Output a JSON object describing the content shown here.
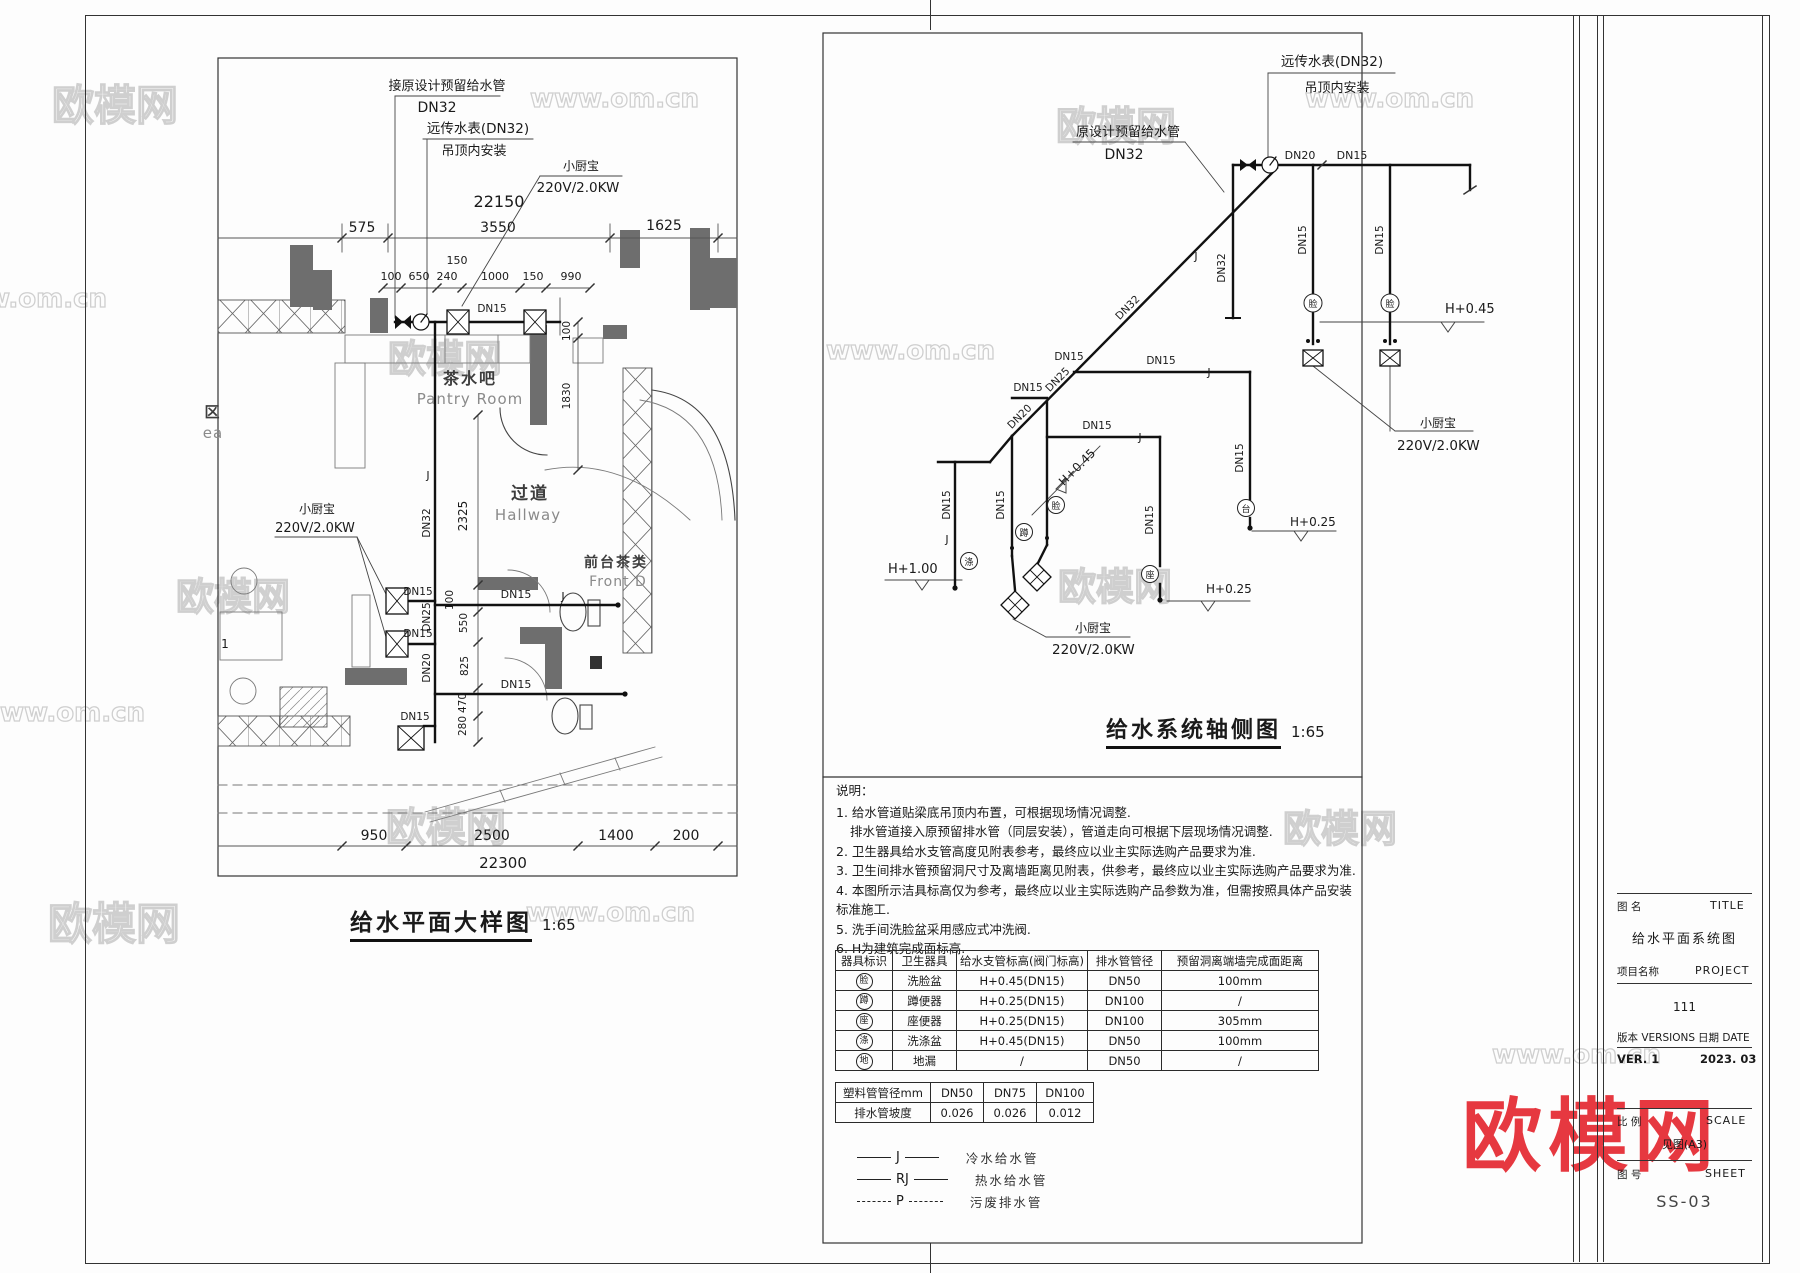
{
  "plan": {
    "title": "给水平面大样图",
    "scale": "1:65",
    "labels": [
      {
        "t": "接原设计预留给水管",
        "x": 447,
        "y": 90,
        "s": 13
      },
      {
        "t": "DN32",
        "x": 437,
        "y": 112,
        "s": 14
      },
      {
        "t": "远传水表(DN32)",
        "x": 478,
        "y": 133,
        "s": 13.5
      },
      {
        "t": "吊顶内安装",
        "x": 474,
        "y": 155,
        "s": 13
      },
      {
        "t": "小厨宝",
        "x": 581,
        "y": 170,
        "s": 12
      },
      {
        "t": "220V/2.0KW",
        "x": 578,
        "y": 192,
        "s": 13.5
      },
      {
        "t": "22150",
        "x": 499,
        "y": 207,
        "s": 16
      },
      {
        "t": "575",
        "x": 362,
        "y": 232,
        "s": 14
      },
      {
        "t": "3550",
        "x": 498,
        "y": 232,
        "s": 14
      },
      {
        "t": "1625",
        "x": 664,
        "y": 230,
        "s": 14
      },
      {
        "t": "150",
        "x": 457,
        "y": 264,
        "s": 11
      },
      {
        "t": "100",
        "x": 391,
        "y": 280,
        "s": 11
      },
      {
        "t": "650",
        "x": 419,
        "y": 280,
        "s": 11
      },
      {
        "t": "240",
        "x": 447,
        "y": 280,
        "s": 11
      },
      {
        "t": "1000",
        "x": 495,
        "y": 280,
        "s": 11
      },
      {
        "t": "150",
        "x": 533,
        "y": 280,
        "s": 11
      },
      {
        "t": "990",
        "x": 571,
        "y": 280,
        "s": 11
      },
      {
        "t": "DN15",
        "x": 492,
        "y": 312,
        "s": 10.5
      },
      {
        "t": "100",
        "x": 570,
        "y": 331,
        "s": 10.5,
        "r": -90
      },
      {
        "t": "1830",
        "x": 570,
        "y": 396,
        "s": 10.5,
        "r": -90
      },
      {
        "t": "茶水吧",
        "x": 470,
        "y": 384,
        "s": 16,
        "c": "room"
      },
      {
        "t": "Pantry Room",
        "x": 470,
        "y": 404,
        "s": 15,
        "c": "rooml"
      },
      {
        "t": "过道",
        "x": 530,
        "y": 499,
        "s": 17,
        "c": "room"
      },
      {
        "t": "Hallway",
        "x": 528,
        "y": 520,
        "s": 15,
        "c": "rooml"
      },
      {
        "t": "2325",
        "x": 467,
        "y": 516,
        "s": 12,
        "r": -90
      },
      {
        "t": "DN32",
        "x": 430,
        "y": 523,
        "s": 10.5,
        "r": -90
      },
      {
        "t": "J",
        "x": 428,
        "y": 479,
        "s": 11
      },
      {
        "t": "小厨宝",
        "x": 317,
        "y": 513,
        "s": 12
      },
      {
        "t": "220V/2.0KW",
        "x": 315,
        "y": 532,
        "s": 13
      },
      {
        "t": "DN15",
        "x": 418,
        "y": 595,
        "s": 10.5
      },
      {
        "t": "DN25",
        "x": 430,
        "y": 617,
        "s": 10.5,
        "r": -90
      },
      {
        "t": "DN15",
        "x": 418,
        "y": 637,
        "s": 10.5
      },
      {
        "t": "DN20",
        "x": 430,
        "y": 668,
        "s": 10.5,
        "r": -90
      },
      {
        "t": "100",
        "x": 453,
        "y": 600,
        "s": 10.5,
        "r": -90
      },
      {
        "t": "550",
        "x": 467,
        "y": 623,
        "s": 10.5,
        "r": -90
      },
      {
        "t": "825",
        "x": 468,
        "y": 666,
        "s": 10.5,
        "r": -90
      },
      {
        "t": "470",
        "x": 466,
        "y": 703,
        "s": 10.5,
        "r": -90
      },
      {
        "t": "280",
        "x": 466,
        "y": 726,
        "s": 10.5,
        "r": -90
      },
      {
        "t": "DN15",
        "x": 516,
        "y": 598,
        "s": 11
      },
      {
        "t": "J",
        "x": 563,
        "y": 600,
        "s": 11
      },
      {
        "t": "DN15",
        "x": 516,
        "y": 688,
        "s": 11
      },
      {
        "t": "DN15",
        "x": 415,
        "y": 720,
        "s": 10.5
      },
      {
        "t": "区",
        "x": 213,
        "y": 417,
        "s": 15,
        "c": "room"
      },
      {
        "t": "ea",
        "x": 213,
        "y": 438,
        "s": 15,
        "c": "rooml"
      },
      {
        "t": "1",
        "x": 225,
        "y": 648,
        "s": 12
      },
      {
        "t": "前台茶类",
        "x": 616,
        "y": 567,
        "s": 14,
        "c": "room"
      },
      {
        "t": "Front D",
        "x": 618,
        "y": 586,
        "s": 14,
        "c": "rooml"
      },
      {
        "t": "950",
        "x": 374,
        "y": 840,
        "s": 14
      },
      {
        "t": "2500",
        "x": 492,
        "y": 840,
        "s": 14
      },
      {
        "t": "1400",
        "x": 616,
        "y": 840,
        "s": 14
      },
      {
        "t": "200",
        "x": 686,
        "y": 840,
        "s": 14
      },
      {
        "t": "22300",
        "x": 503,
        "y": 868,
        "s": 15
      }
    ]
  },
  "axon": {
    "title": "给水系统轴侧图",
    "scale": "1:65",
    "labels": [
      {
        "t": "远传水表(DN32)",
        "x": 1332,
        "y": 66,
        "s": 13.5
      },
      {
        "t": "吊顶内安装",
        "x": 1337,
        "y": 92,
        "s": 13
      },
      {
        "t": "原设计预留给水管",
        "x": 1128,
        "y": 136,
        "s": 13
      },
      {
        "t": "DN32",
        "x": 1124,
        "y": 159,
        "s": 14
      },
      {
        "t": "DN20",
        "x": 1300,
        "y": 159,
        "s": 11
      },
      {
        "t": "DN15",
        "x": 1352,
        "y": 159,
        "s": 11
      },
      {
        "t": "DN32",
        "x": 1225,
        "y": 268,
        "s": 10.5,
        "r": -90
      },
      {
        "t": "DN32",
        "x": 1130,
        "y": 310,
        "s": 10.5,
        "r": -45
      },
      {
        "t": "J",
        "x": 1196,
        "y": 260,
        "s": 11
      },
      {
        "t": "DN15",
        "x": 1306,
        "y": 240,
        "s": 10.5,
        "r": -90
      },
      {
        "t": "DN15",
        "x": 1383,
        "y": 240,
        "s": 10.5,
        "r": -90
      },
      {
        "t": "脸",
        "x": 1313,
        "y": 307,
        "s": 9
      },
      {
        "t": "脸",
        "x": 1390,
        "y": 307,
        "s": 9
      },
      {
        "t": "H+0.45",
        "x": 1445,
        "y": 313,
        "s": 13,
        "a": "start"
      },
      {
        "t": "小厨宝",
        "x": 1420,
        "y": 427,
        "s": 12,
        "a": "start"
      },
      {
        "t": "220V/2.0KW",
        "x": 1397,
        "y": 450,
        "s": 13.5,
        "a": "start"
      },
      {
        "t": "DN15",
        "x": 1069,
        "y": 360,
        "s": 10.5
      },
      {
        "t": "DN25",
        "x": 1060,
        "y": 382,
        "s": 10.5,
        "r": -45
      },
      {
        "t": "DN15",
        "x": 1161,
        "y": 364,
        "s": 10.5
      },
      {
        "t": "DN15",
        "x": 1028,
        "y": 391,
        "s": 10.5
      },
      {
        "t": "DN20",
        "x": 1022,
        "y": 419,
        "s": 10.5,
        "r": -45
      },
      {
        "t": "DN15",
        "x": 1097,
        "y": 429,
        "s": 10.5
      },
      {
        "t": "J",
        "x": 1209,
        "y": 376,
        "s": 11
      },
      {
        "t": "J",
        "x": 1140,
        "y": 441,
        "s": 11
      },
      {
        "t": "DN15",
        "x": 1243,
        "y": 458,
        "s": 10.5,
        "r": -90
      },
      {
        "t": "H+0.45",
        "x": 1080,
        "y": 470,
        "s": 12,
        "r": -45
      },
      {
        "t": "DN15",
        "x": 950,
        "y": 505,
        "s": 10.5,
        "r": -90
      },
      {
        "t": "DN15",
        "x": 1004,
        "y": 505,
        "s": 10.5,
        "r": -90
      },
      {
        "t": "DN15",
        "x": 1153,
        "y": 520,
        "s": 10.5,
        "r": -90
      },
      {
        "t": "J",
        "x": 947,
        "y": 543,
        "s": 11
      },
      {
        "t": "H+1.00",
        "x": 888,
        "y": 573,
        "s": 13,
        "a": "start"
      },
      {
        "t": "涤",
        "x": 969,
        "y": 565,
        "s": 9
      },
      {
        "t": "蹲",
        "x": 1024,
        "y": 536,
        "s": 9
      },
      {
        "t": "脸",
        "x": 1056,
        "y": 509,
        "s": 9
      },
      {
        "t": "座",
        "x": 1150,
        "y": 578,
        "s": 9
      },
      {
        "t": "台",
        "x": 1246,
        "y": 512,
        "s": 9
      },
      {
        "t": "H+0.25",
        "x": 1290,
        "y": 526,
        "s": 12,
        "a": "start"
      },
      {
        "t": "H+0.25",
        "x": 1206,
        "y": 593,
        "s": 12,
        "a": "start"
      },
      {
        "t": "小厨宝",
        "x": 1075,
        "y": 632,
        "s": 12,
        "a": "start"
      },
      {
        "t": "220V/2.0KW",
        "x": 1052,
        "y": 654,
        "s": 13.5,
        "a": "start"
      }
    ]
  },
  "notes": {
    "heading": "说明：",
    "lines": [
      {
        "n": "1.",
        "t": "给水管道贴梁底吊顶内布置，可根据现场情况调整."
      },
      {
        "n": "",
        "t": "排水管道接入原预留排水管（同层安装），管道走向可根据下层现场情况调整."
      },
      {
        "n": "2.",
        "t": "卫生器具给水支管高度见附表参考，最终应以业主实际选购产品要求为准."
      },
      {
        "n": "3.",
        "t": "卫生间排水管预留洞尺寸及离墙距离见附表，供参考，最终应以业主实际选购产品要求为准."
      },
      {
        "n": "4.",
        "t": "本图所示洁具标高仅为参考，最终应以业主实际选购产品参数为准，但需按照具体产品安装标准施工."
      },
      {
        "n": "5.",
        "t": "洗手间洗脸盆采用感应式冲洗阀."
      },
      {
        "n": "6.",
        "t": "H为建筑完成面标高."
      }
    ]
  },
  "fixture_table": {
    "headers": [
      "器具标识",
      "卫生器具",
      "给水支管标高(阀门标高)",
      "排水管管径",
      "预留洞离端墙完成面距离"
    ],
    "rows": [
      [
        "脸",
        "洗脸盆",
        "H+0.45(DN15)",
        "DN50",
        "100mm"
      ],
      [
        "蹲",
        "蹲便器",
        "H+0.25(DN15)",
        "DN100",
        "/"
      ],
      [
        "座",
        "座便器",
        "H+0.25(DN15)",
        "DN100",
        "305mm"
      ],
      [
        "涤",
        "洗涤盆",
        "H+0.45(DN15)",
        "DN50",
        "100mm"
      ],
      [
        "地",
        "地漏",
        "/",
        "DN50",
        "/"
      ]
    ]
  },
  "slope_table": {
    "rows": [
      [
        "塑料管管径mm",
        "DN50",
        "DN75",
        "DN100"
      ],
      [
        "排水管坡度",
        "0.026",
        "0.026",
        "0.012"
      ]
    ]
  },
  "legend": {
    "items": [
      {
        "symbol": "J",
        "style": "solid",
        "label": "冷水给水管"
      },
      {
        "symbol": "RJ",
        "style": "solid",
        "label": "热水给水管"
      },
      {
        "symbol": "P",
        "style": "dashed",
        "label": "污废排水管"
      }
    ]
  },
  "titleblock": {
    "name_label": "图  名",
    "name_en": "TITLE",
    "drawing_title": "给水平面系统图",
    "project_label": "项目名称",
    "project_en": "PROJECT",
    "project": "111",
    "version_label": "版本  VERSIONS",
    "date_label": "日期  DATE",
    "version": "VER. 1",
    "date": "2023. 03",
    "scale_label": "比  例",
    "scale_en": "SCALE",
    "scale": "见图(A3)",
    "sheet_label": "图  号",
    "sheet_en": "SHEET",
    "sheet": "SS-03"
  },
  "watermarks": [
    {
      "text": "欧模网",
      "x": 52,
      "y": 72,
      "size": 42,
      "style": "outline"
    },
    {
      "text": "www.om.cn",
      "x": 530,
      "y": 84,
      "size": 26,
      "style": "outline"
    },
    {
      "text": "www.om.cn",
      "x": 1305,
      "y": 84,
      "size": 26,
      "style": "outline"
    },
    {
      "text": "欧模网",
      "x": 1056,
      "y": 94,
      "size": 40,
      "style": "outline"
    },
    {
      "text": "www.om.cn",
      "x": -62,
      "y": 284,
      "size": 26,
      "style": "outline"
    },
    {
      "text": "欧模网",
      "x": 388,
      "y": 328,
      "size": 38,
      "style": "outline"
    },
    {
      "text": "www.om.cn",
      "x": 826,
      "y": 336,
      "size": 26,
      "style": "outline"
    },
    {
      "text": "欧模网",
      "x": 176,
      "y": 566,
      "size": 38,
      "style": "outline"
    },
    {
      "text": "欧模网",
      "x": 1058,
      "y": 556,
      "size": 38,
      "style": "outline"
    },
    {
      "text": "www.om.cn",
      "x": -24,
      "y": 698,
      "size": 26,
      "style": "outline"
    },
    {
      "text": "欧模网",
      "x": 386,
      "y": 795,
      "size": 40,
      "style": "outline"
    },
    {
      "text": "欧模网",
      "x": 1283,
      "y": 798,
      "size": 38,
      "style": "outline"
    },
    {
      "text": "www.om.cn",
      "x": 526,
      "y": 898,
      "size": 26,
      "style": "outline"
    },
    {
      "text": "欧模网",
      "x": 48,
      "y": 888,
      "size": 44,
      "style": "outline"
    },
    {
      "text": "www.om.cn",
      "x": 1492,
      "y": 1040,
      "size": 26,
      "style": "outline"
    },
    {
      "text": "欧模网",
      "x": 1462,
      "y": 1072,
      "size": 80,
      "style": "red"
    }
  ]
}
